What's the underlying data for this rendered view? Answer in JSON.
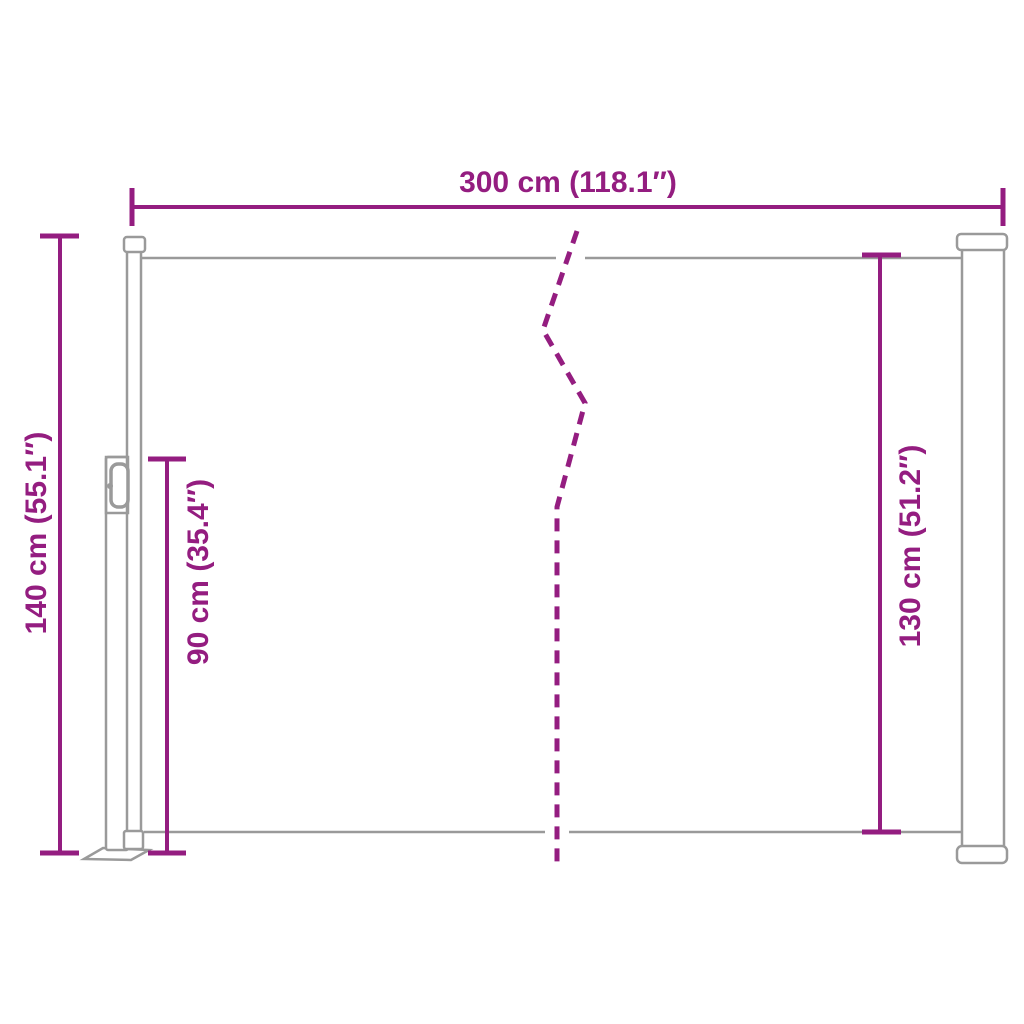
{
  "diagram": {
    "title": "retractable-side-awning-dimension-diagram",
    "labels": {
      "width": "300 cm (118.1″)",
      "total_height": "140 cm (55.1″)",
      "post_height": "90 cm (35.4″)",
      "fabric_height": "130 cm (51.2″)"
    }
  },
  "colors": {
    "dimension": "#941d80",
    "drawing": "#9a9a9a",
    "background": "#ffffff"
  }
}
